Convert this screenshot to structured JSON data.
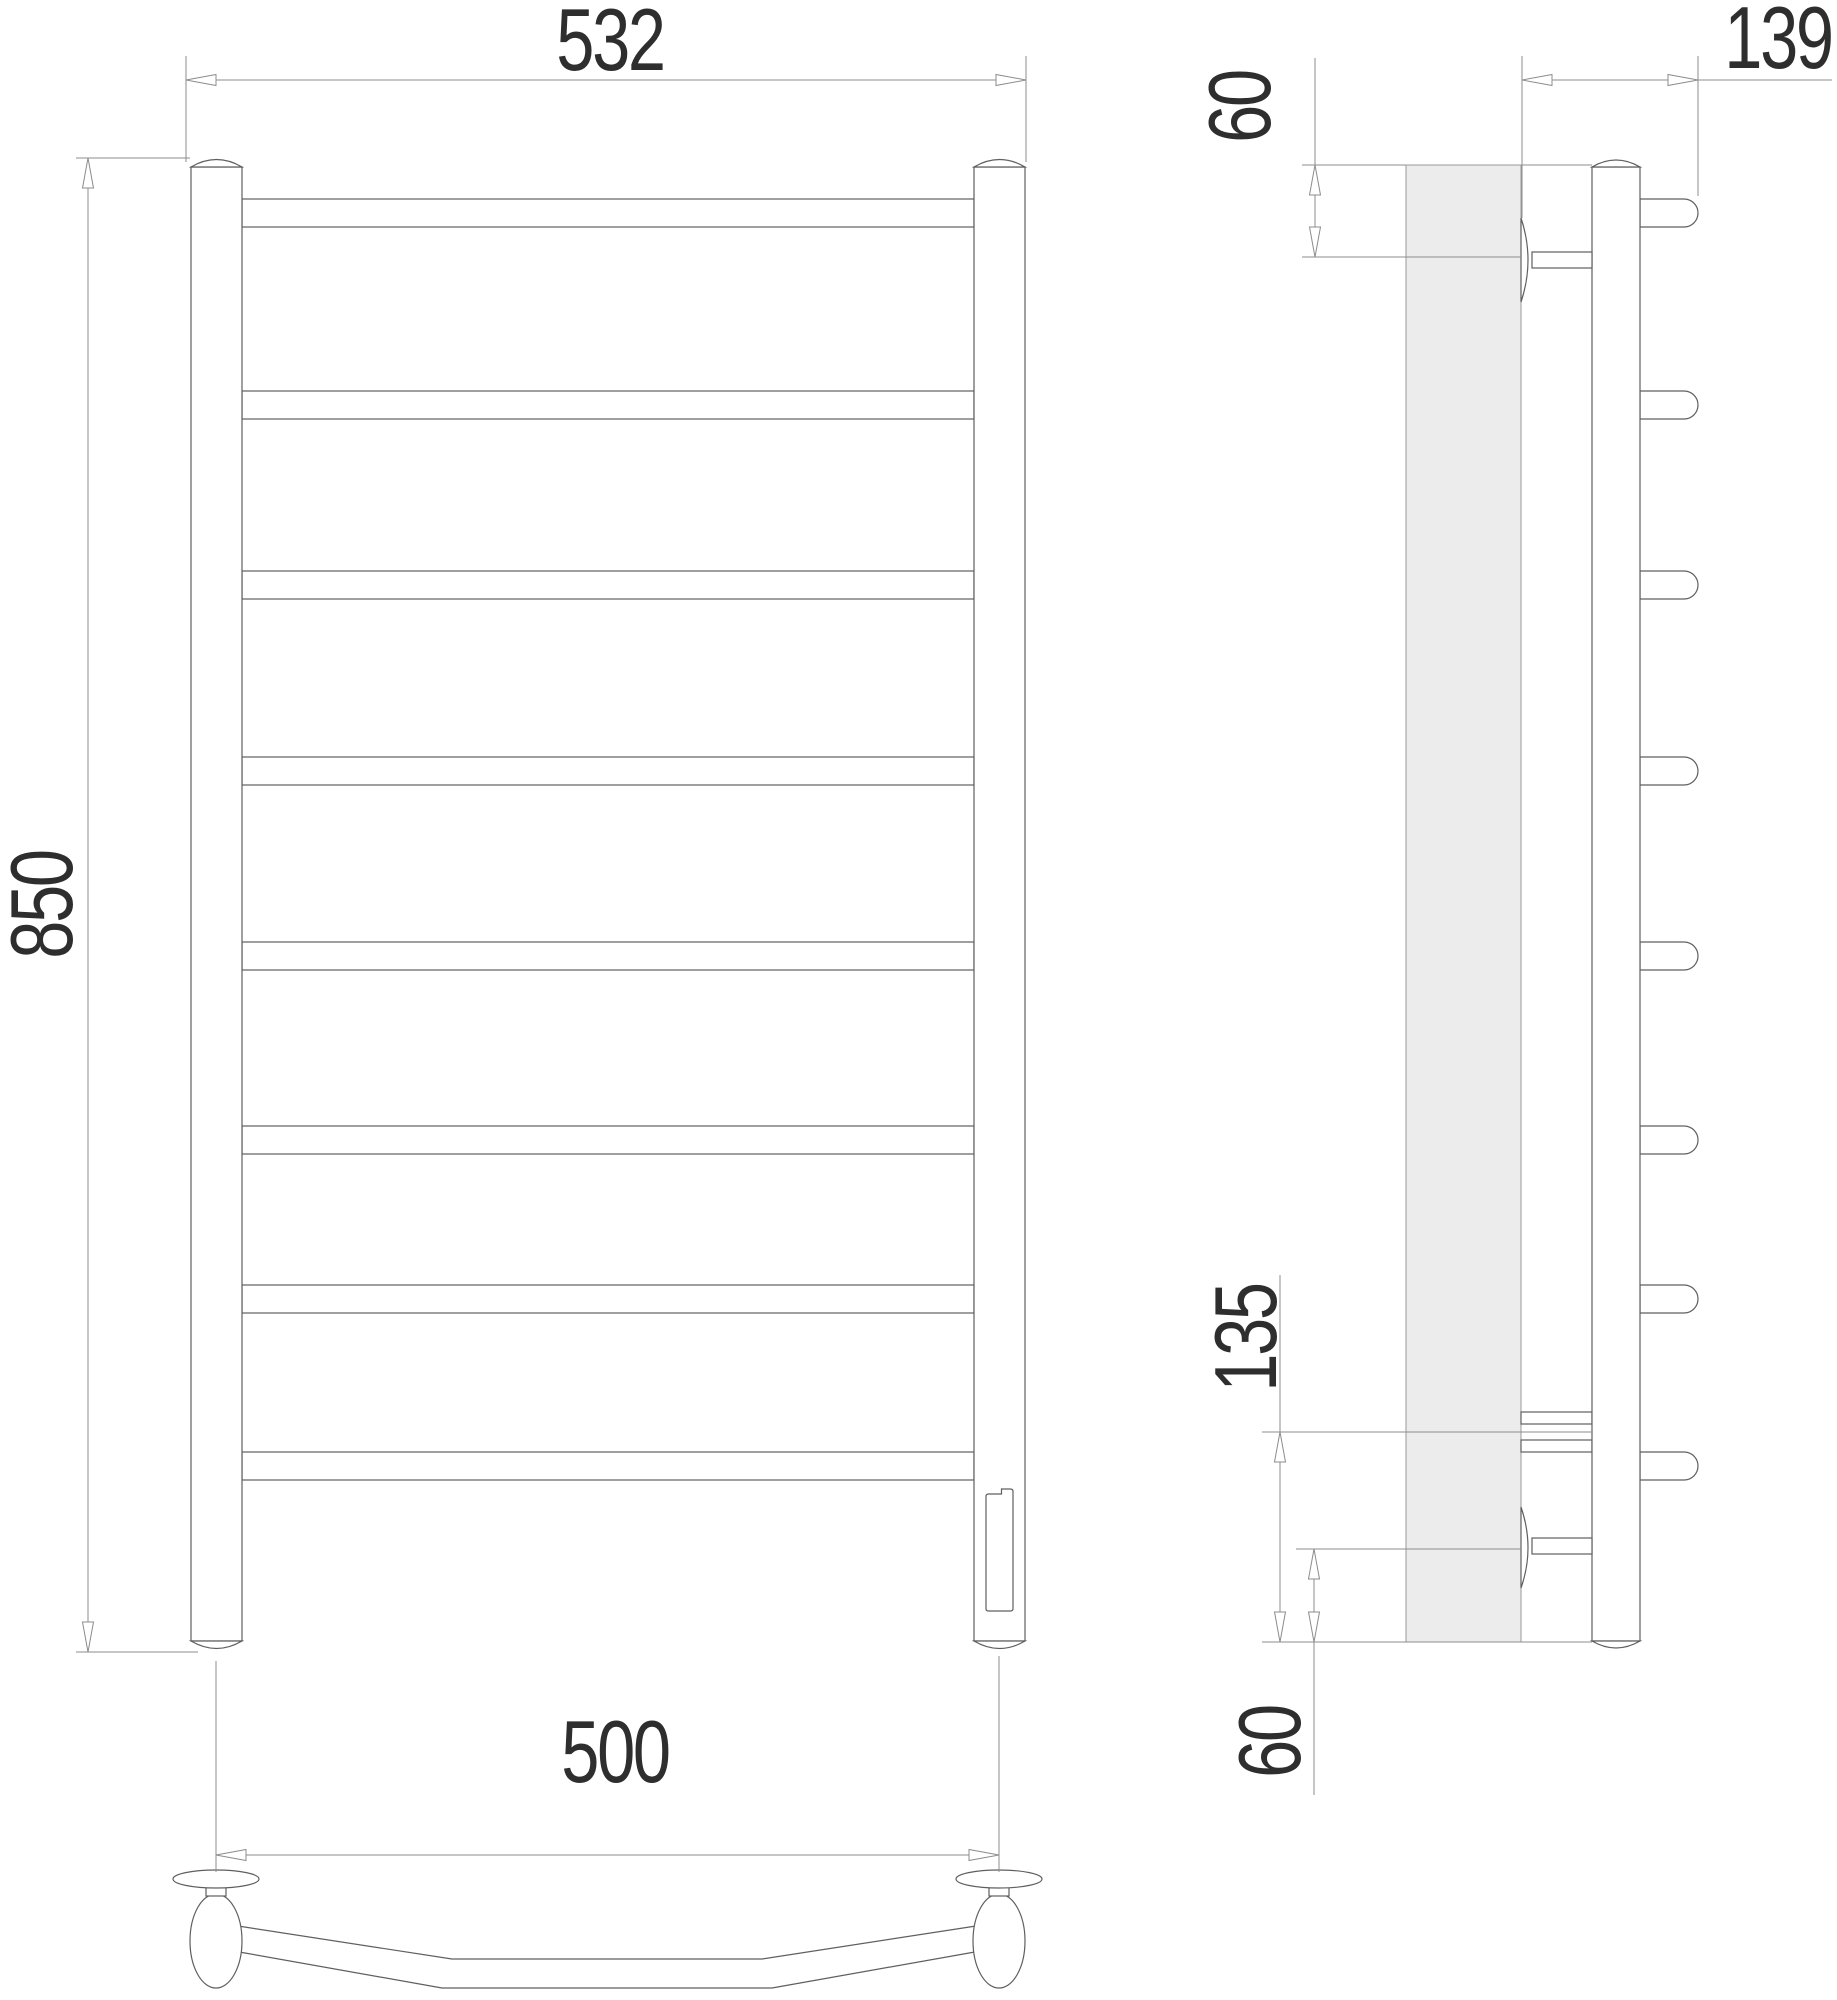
{
  "colors": {
    "object-line": "#5f5f5f",
    "dim-line": "#8c8c8c",
    "text": "#2e2e2e",
    "wall-fill": "#ececec"
  },
  "drawing": {
    "description": "Technical drawing of a ladder-style heated towel rail with front, side and top views",
    "front_view": {
      "rung_count": 8
    },
    "dimensions": {
      "overall_width": "532",
      "overall_height": "850",
      "mounting_width": "500",
      "depth": "139",
      "top_bracket_offset": "60",
      "bottom_span": "135",
      "bottom_bracket_offset": "60"
    }
  }
}
